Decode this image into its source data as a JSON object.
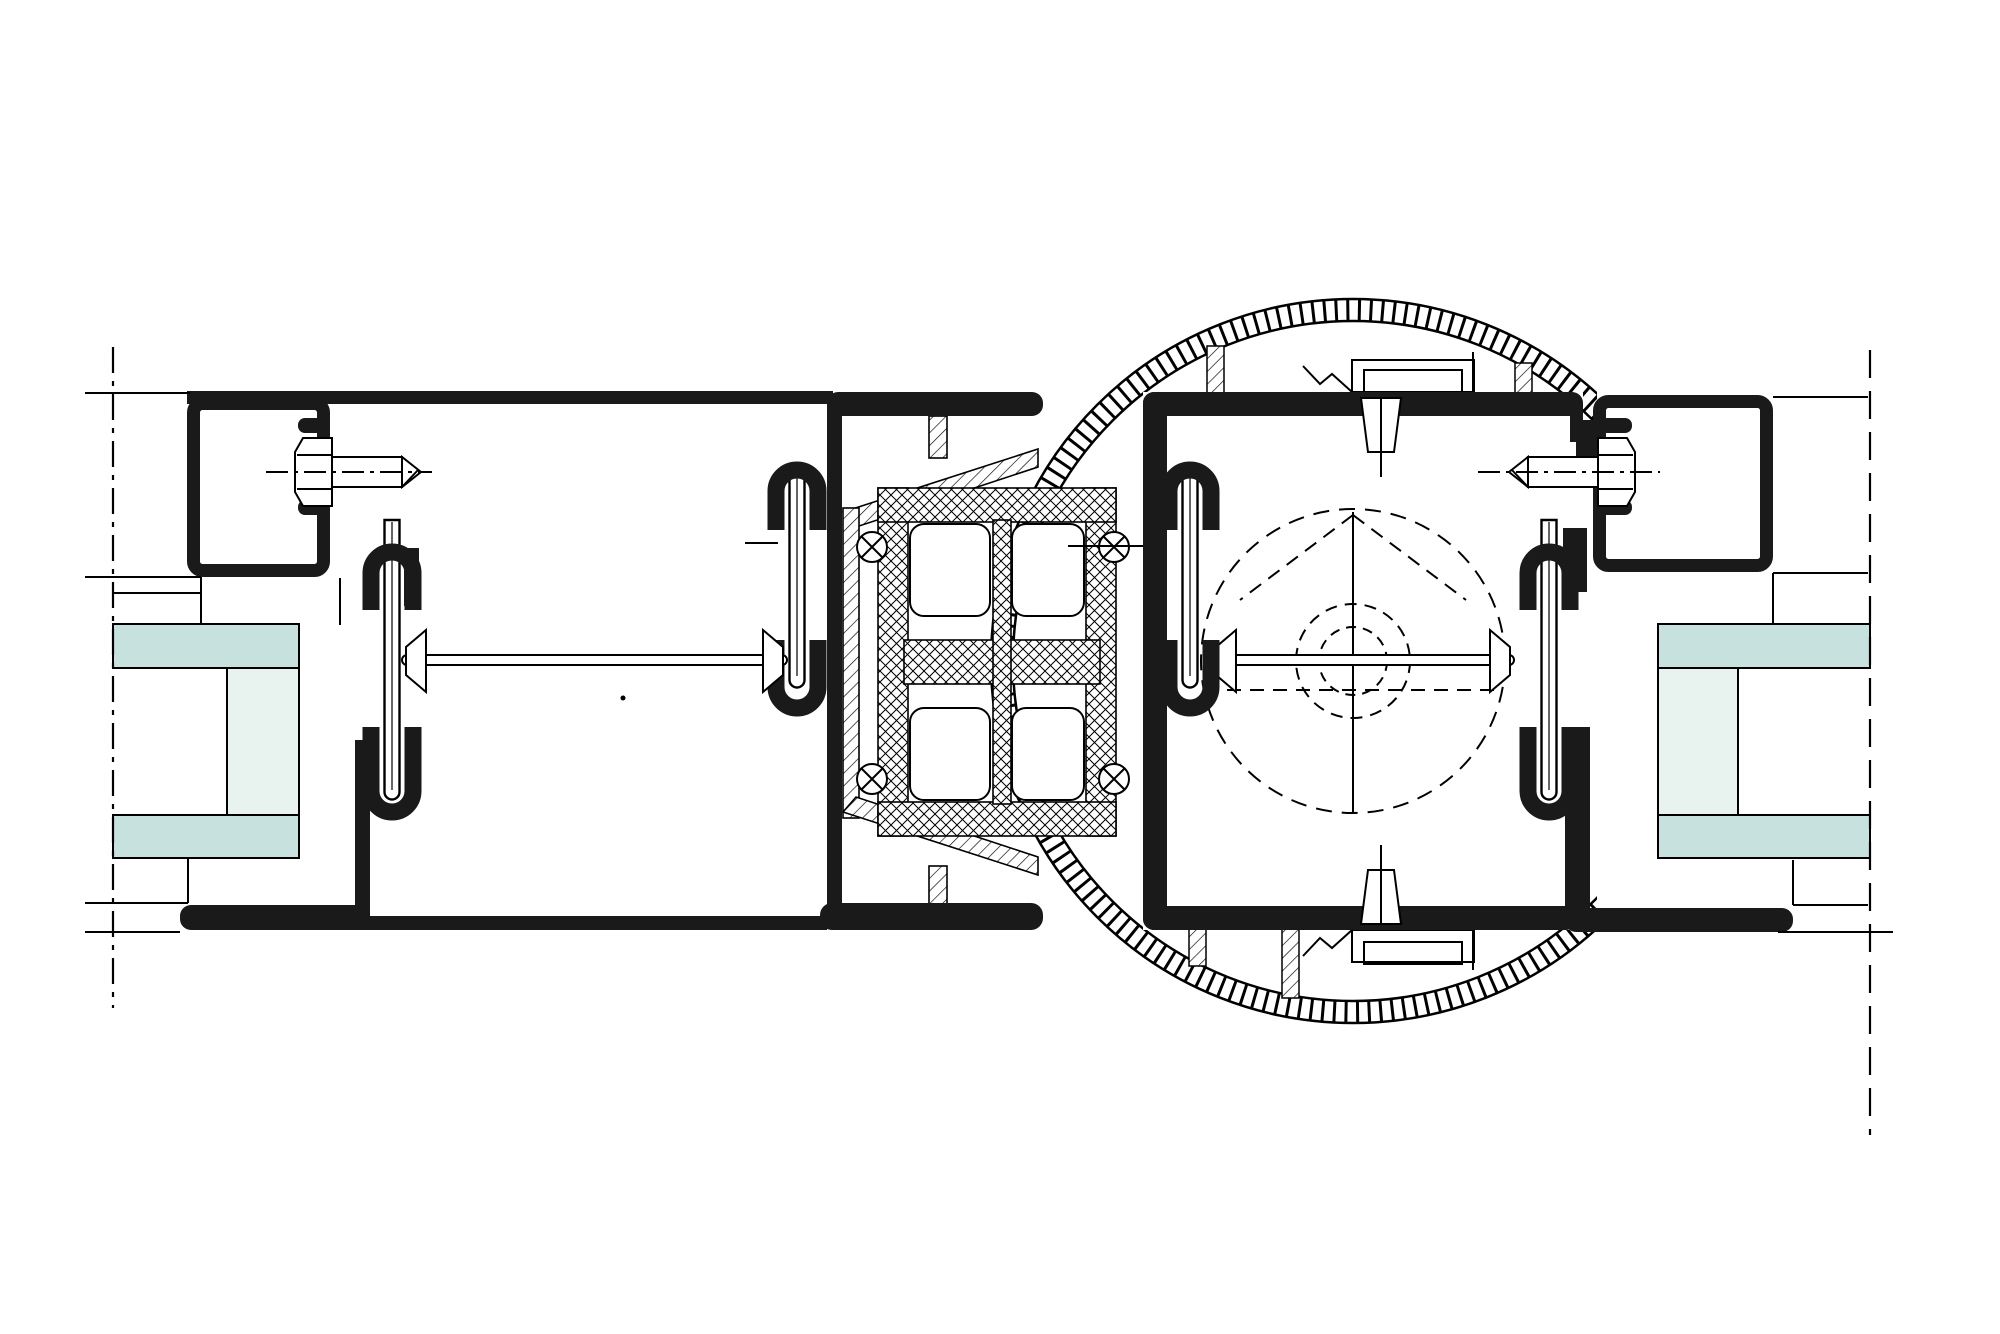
{
  "meta": {
    "drawing_type": "technical-cross-section-detail",
    "description_labels": {
      "left_frame": "outer-frame-profile-left",
      "left_sash": "door-leaf-profile-left",
      "connector": "thermal-break-center-connector",
      "hinge": "round-hinge-knuckle-shell",
      "right_sash": "door-leaf-profile-right",
      "right_frame": "outer-frame-profile-right",
      "glass_left": "insulating-glass-unit-left",
      "glass_right": "insulating-glass-unit-right"
    },
    "visible_text_items": []
  },
  "colors": {
    "background": "#ffffff",
    "profile_black": "#1a1a1a",
    "line_black": "#000000",
    "glass_pane": "#c7e2de",
    "glass_spacer": "#e8f3f0",
    "white": "#ffffff"
  }
}
